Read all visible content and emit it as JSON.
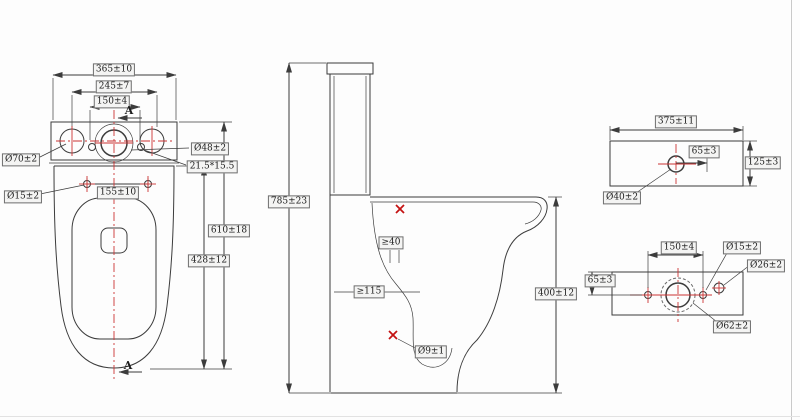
{
  "drawing": {
    "type": "technical-drawing",
    "subject": "two-piece toilet dimension drawing",
    "colors": {
      "line": "#3c3c3c",
      "centerline_red": "#cc3434",
      "mark_red": "#c41212",
      "label_bg": "#f4f4f3"
    },
    "plan_view": {
      "section_label_top": "A",
      "section_label_bottom": "A",
      "overall_width": "365±10",
      "hole_span_outer": "245±7",
      "hole_span_inner": "150±4",
      "spud_hole_diameter": "Ø70±2",
      "fixing_hole_diameter": "Ø15±2",
      "flush_hole_diameter": "Ø48±2",
      "seat_slot_size": "21.5*15.5",
      "fixing_hole_spacing": "155±10",
      "overall_depth": "610±18",
      "bowl_depth": "428±12"
    },
    "side_view": {
      "overall_height": "785±23",
      "rim_channel_min": "≥40",
      "water_seal_min": "≥115",
      "bowl_height": "400±12",
      "outlet_hole_diameter": "Ø9±1"
    },
    "lid_view": {
      "width": "375±11",
      "hole_offset": "65±3",
      "depth": "125±3",
      "button_hole_diameter": "Ø40±2"
    },
    "back_view": {
      "hole_spacing": "150±4",
      "side_hole_diameter": "Ø15±2",
      "inlet_hole_diameter": "Ø26±2",
      "hole_offset": "65±3",
      "valve_hole_diameter": "Ø62±2"
    }
  }
}
